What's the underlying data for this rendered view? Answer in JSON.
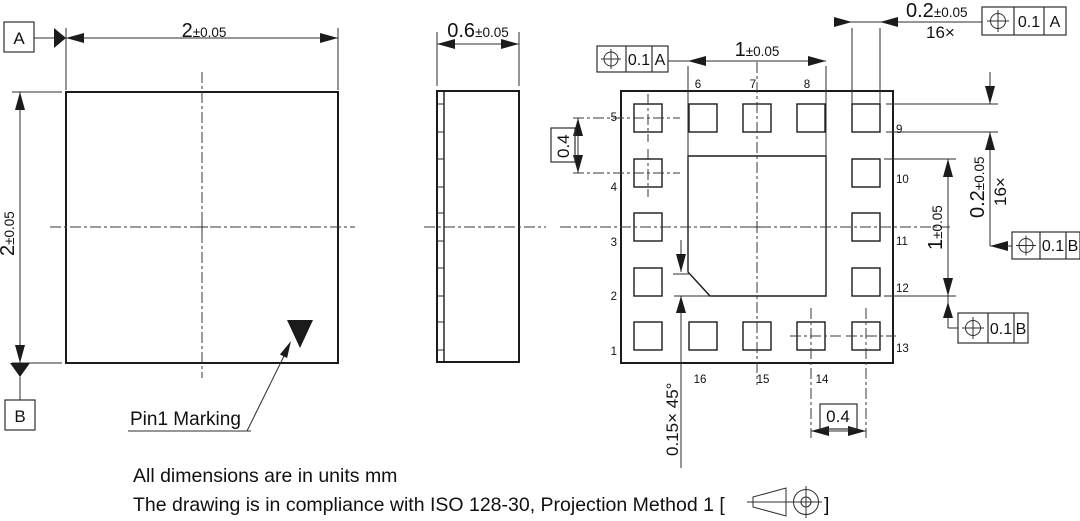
{
  "top_view": {
    "width": {
      "value": "2",
      "tol": "±0.05"
    },
    "height": {
      "value": "2",
      "tol": "±0.05"
    },
    "datum_a": "A",
    "datum_b": "B",
    "pin1_label": "Pin1 Marking"
  },
  "side_view": {
    "thickness": {
      "value": "0.6",
      "tol": "±0.05"
    }
  },
  "bottom_view": {
    "epad_width": {
      "value": "1",
      "tol": "±0.05"
    },
    "epad_height": {
      "value": "1",
      "tol": "±0.05"
    },
    "pad_width": {
      "value": "0.2",
      "tol": "±0.05",
      "count": "16×"
    },
    "pad_height": {
      "value": "0.2",
      "tol": "±0.05",
      "count": "16×"
    },
    "pitch_left": "0.4",
    "pitch_bottom": "0.4",
    "chamfer": "0.15× 45°",
    "fcf": {
      "top_left": {
        "tol": "0.1",
        "datum": "A"
      },
      "top_right": {
        "tol": "0.1",
        "datum": "A"
      },
      "right_mid": {
        "tol": "0.1",
        "datum": "B"
      },
      "right_bottom": {
        "tol": "0.1",
        "datum": "B"
      }
    },
    "pad_labels": {
      "left": [
        "5",
        "4",
        "3",
        "2",
        "1"
      ],
      "top": [
        "6",
        "7",
        "8"
      ],
      "right": [
        "9",
        "10",
        "11",
        "12",
        "13"
      ],
      "bottom": [
        "16",
        "15",
        "14"
      ]
    }
  },
  "notes": {
    "units": "All dimensions are in units mm",
    "compliance_prefix": "The drawing is in compliance with ISO 128-30, Projection Method 1 [",
    "compliance_suffix": "]"
  }
}
